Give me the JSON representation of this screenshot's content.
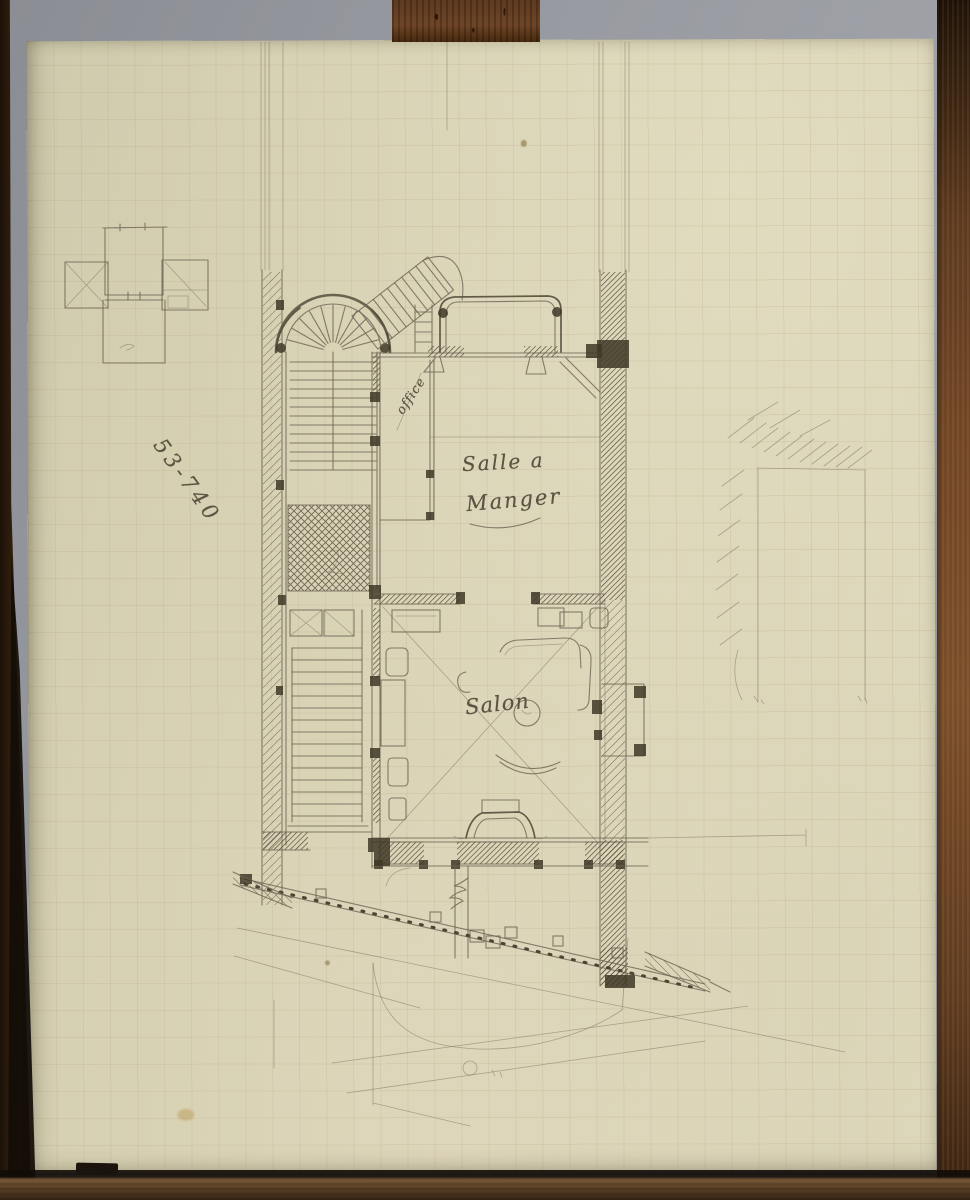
{
  "labels": {
    "dining_room_line1": "Salle a",
    "dining_room_line2": "Manger",
    "salon": "Salon",
    "office": "office",
    "reference_number": "53-740"
  },
  "colors": {
    "wall_grey": "#989aa1",
    "paper_cream": "#d7d2b4",
    "pencil": "#6b6352",
    "pencil_dark": "#3e3827",
    "wood_dark": "#241509",
    "wood_mid": "#6b4425"
  },
  "drawing": {
    "type": "hand-drawn architectural floor plan sketch in graphite on cream graph paper, photographed on a wooden easel",
    "rooms": [
      "Salle a Manger",
      "Salon",
      "office"
    ],
    "features": [
      "semicircular winding staircase",
      "straight stair run",
      "bow window bay",
      "fireplace with chimney breast",
      "party walls hatched",
      "garden curve and street lines below",
      "small cross-shaped plan sketch at upper left",
      "faint hatched opening sketch at right"
    ]
  }
}
